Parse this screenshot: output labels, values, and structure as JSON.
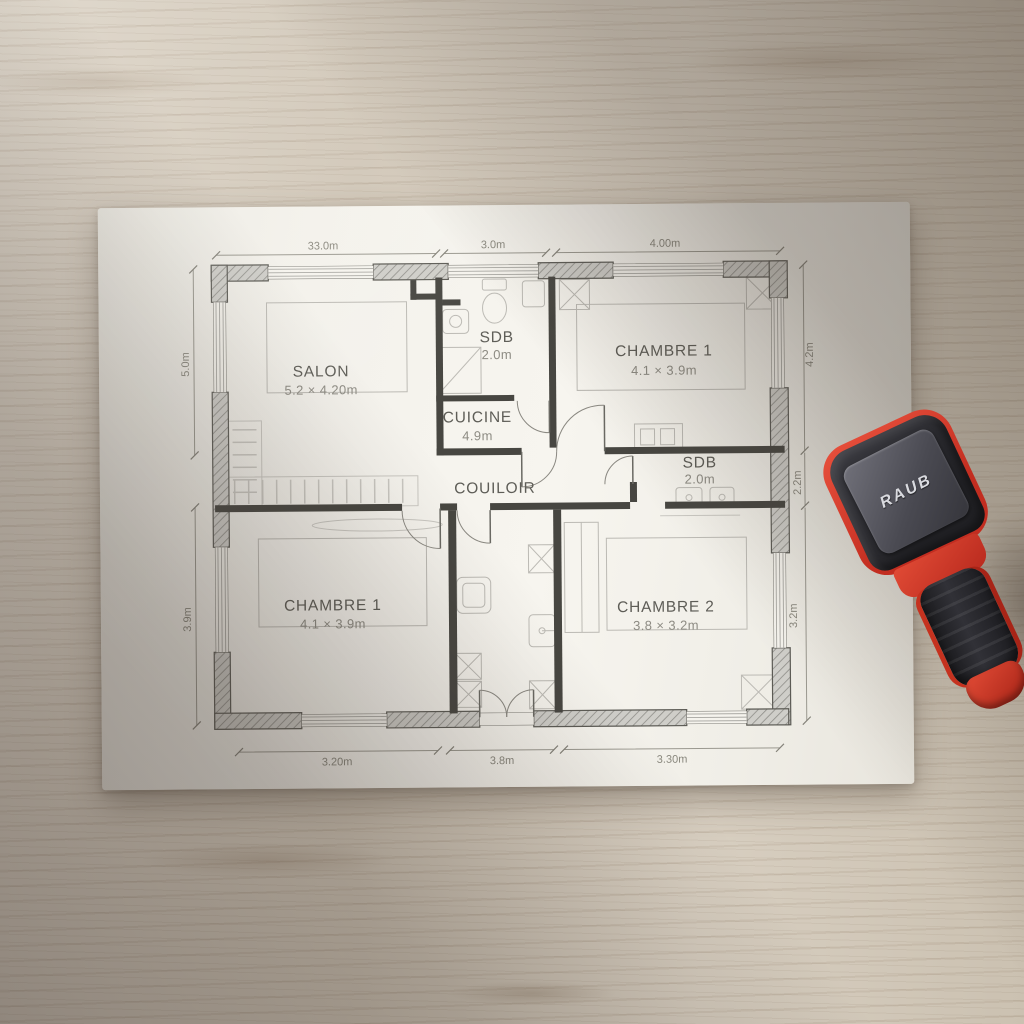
{
  "plan": {
    "rooms": {
      "salon": {
        "label": "SALON",
        "size": "5.2 × 4.20m"
      },
      "sdb_top": {
        "label": "SDB",
        "size": "2.0m"
      },
      "cuisine": {
        "label": "CUICINE",
        "size": "4.9m"
      },
      "chambre1_top": {
        "label": "CHAMBRE 1",
        "size": "4.1 × 3.9m"
      },
      "couloir": {
        "label": "COUILOIR"
      },
      "sdb_right": {
        "label": "SDB",
        "size": "2.0m"
      },
      "chambre1_bottom": {
        "label": "CHAMBRE 1",
        "size": "4.1 × 3.9m"
      },
      "chambre2": {
        "label": "CHAMBRE 2",
        "size": "3.8 × 3.2m"
      }
    },
    "dims": {
      "top": [
        "33.0m",
        "3.0m",
        "4.00m"
      ],
      "bottom": [
        "3.20m",
        "3.8m",
        "3.30m"
      ],
      "left": [
        "5.0m",
        "3.9m"
      ],
      "right": [
        "4.2m",
        "2.2m",
        "3.2m"
      ]
    }
  },
  "device": {
    "brand": "RAUB",
    "body_color": "#d8362a",
    "armor_color": "#26262a"
  },
  "colors": {
    "paper": "#f4f2ec",
    "wood": "#d3c9ba"
  }
}
